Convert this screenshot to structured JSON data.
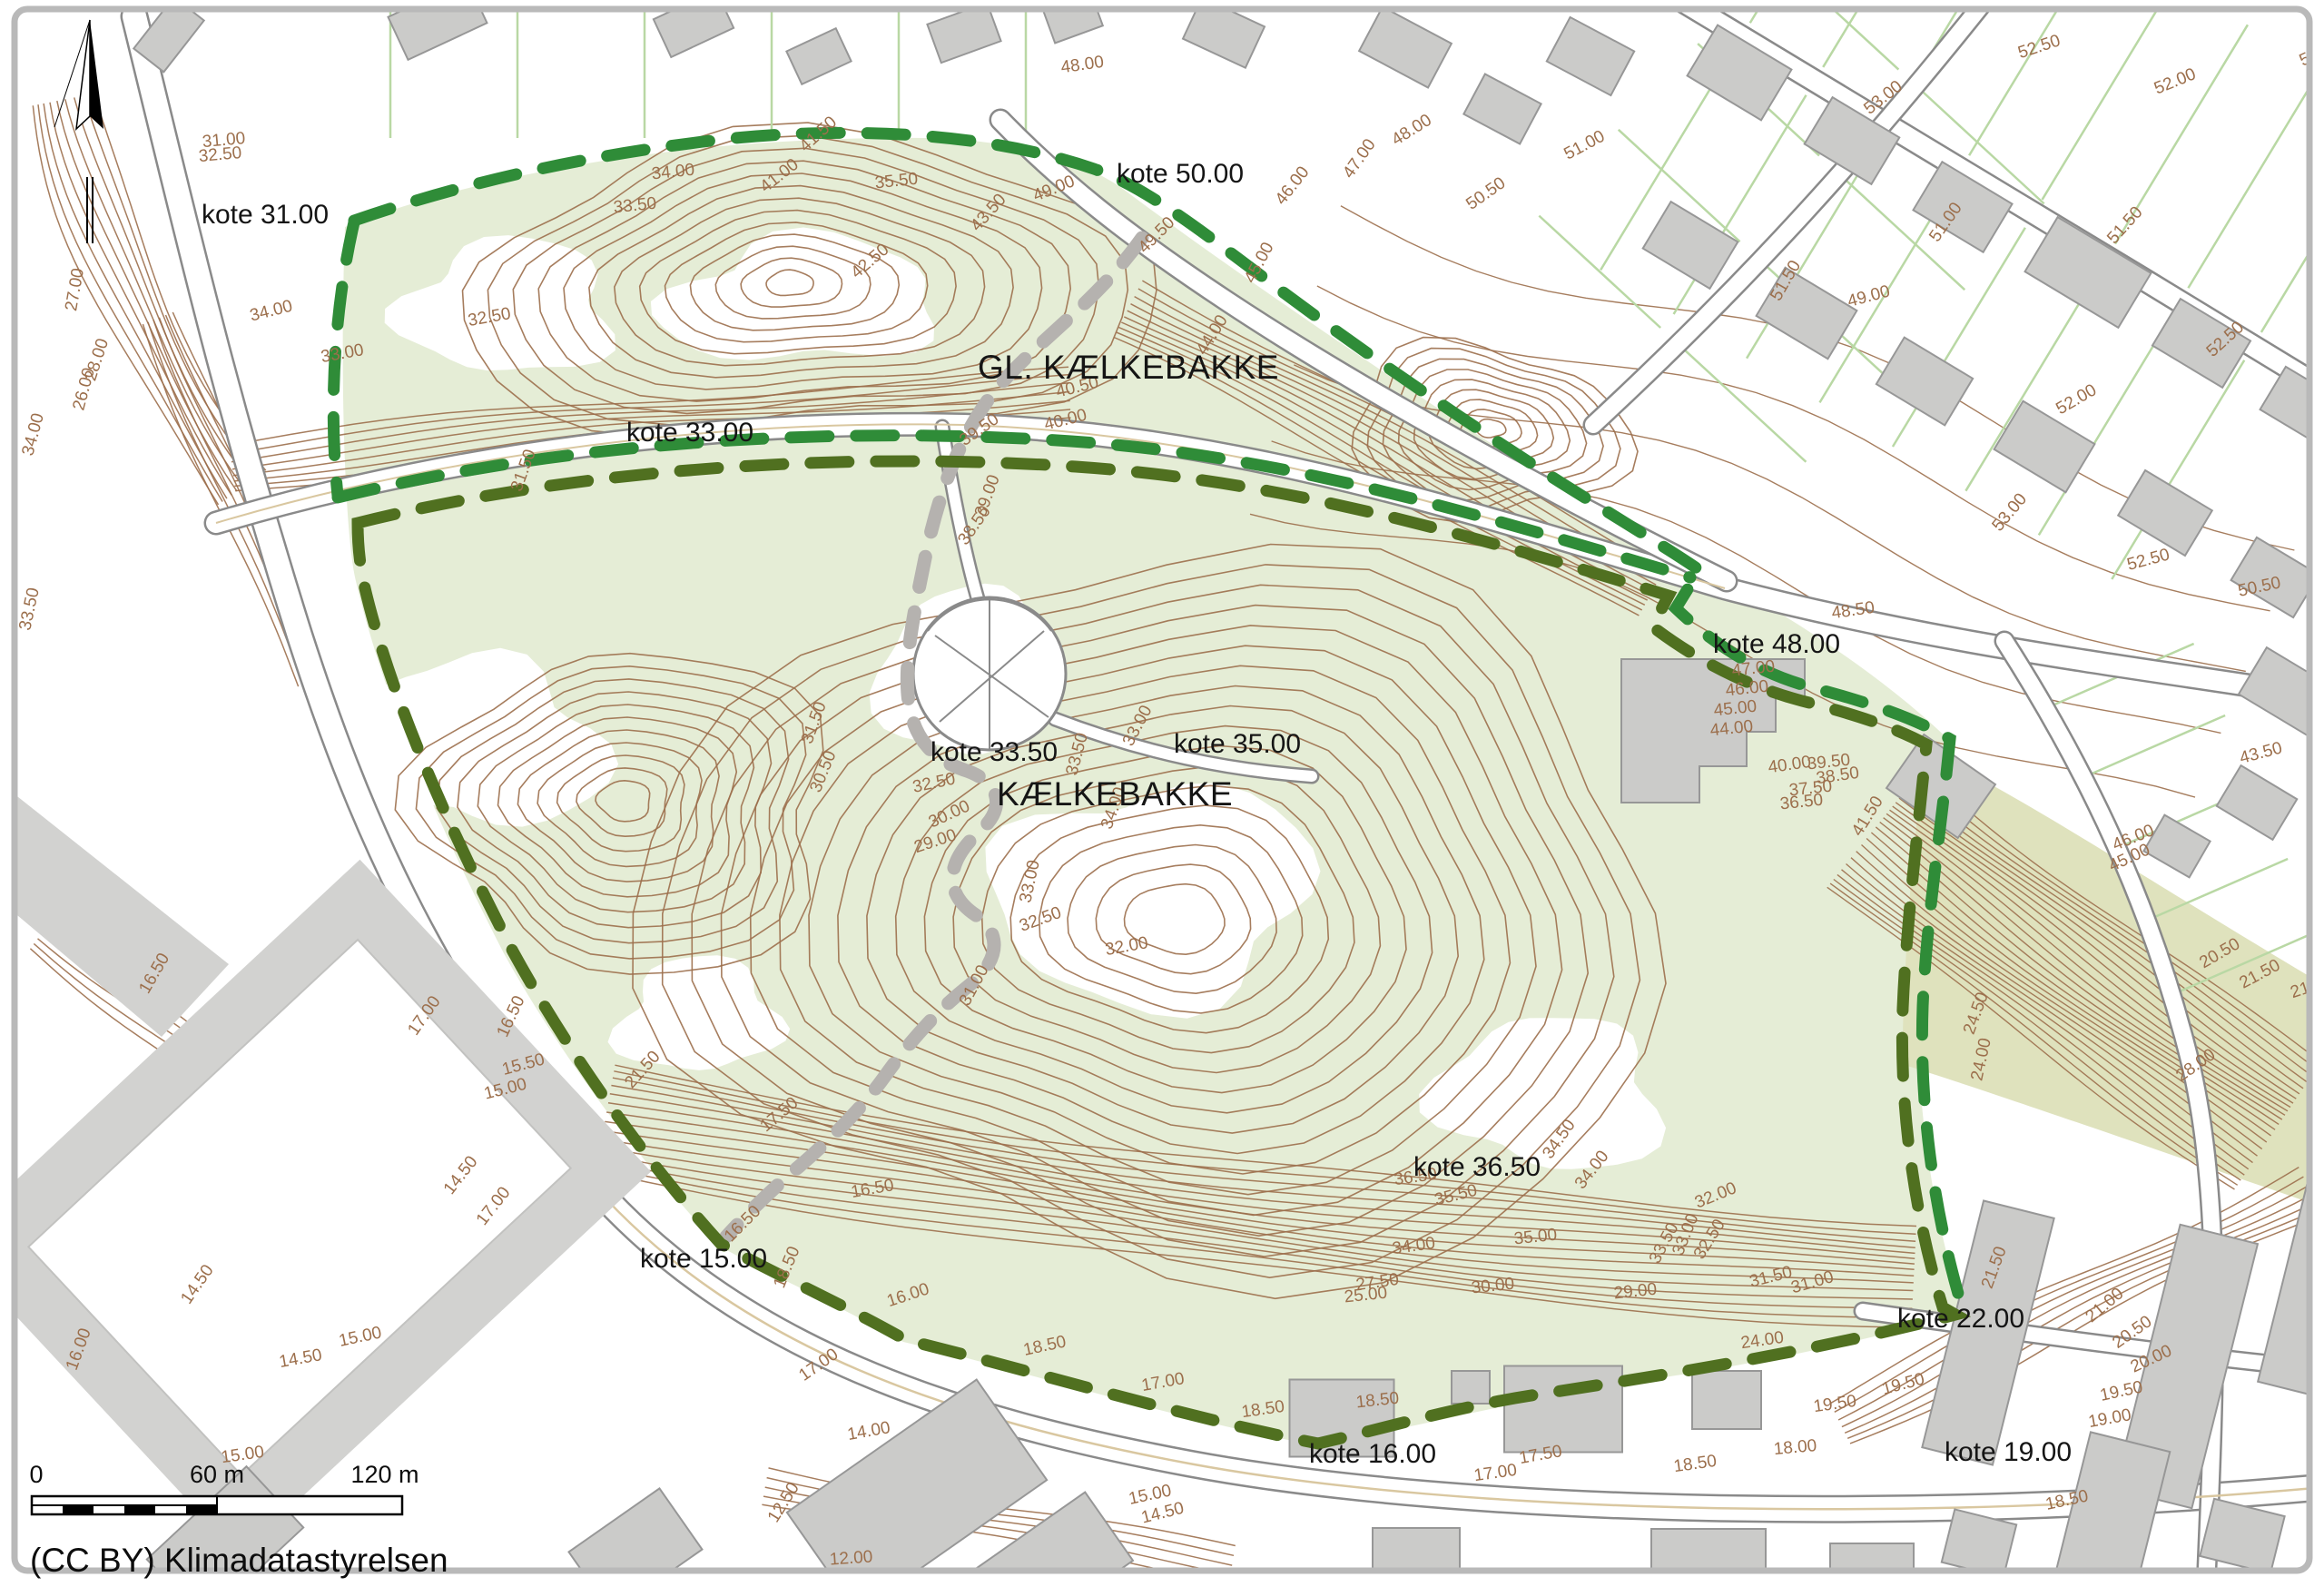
{
  "map": {
    "attribution": "(CC BY) Klimadatastyrelsen",
    "scale_bar": {
      "start": "0",
      "mid": "60 m",
      "end": "120 m"
    },
    "place_labels": [
      {
        "id": "gl-kaelkebakke",
        "text": "GL. KÆLKEBAKKE"
      },
      {
        "id": "kaelkebakke",
        "text": "KÆLKEBAKKE"
      }
    ],
    "kote_labels": [
      {
        "text": "kote 31.00"
      },
      {
        "text": "kote 50.00"
      },
      {
        "text": "kote 33.00"
      },
      {
        "text": "kote 48.00"
      },
      {
        "text": "kote 33.50"
      },
      {
        "text": "kote 35.00"
      },
      {
        "text": "kote 36.50"
      },
      {
        "text": "kote 15.00"
      },
      {
        "text": "kote 22.00"
      },
      {
        "text": "kote 16.00"
      },
      {
        "text": "kote 19.00"
      }
    ],
    "icons": [
      "north-arrow"
    ],
    "colors": {
      "contour": "#9c6f4c",
      "park_fill": "#e5edd6",
      "slope_fill": "#dfe2bd",
      "boundary_bright": "#2f8c38",
      "boundary_dark": "#507020",
      "trail": "#b5b2af",
      "road_casing": "#8a8a8a",
      "road_fill": "#ffffff",
      "building_fill": "#cbcbc9",
      "building_stroke": "#979797",
      "lot_line": "#b9d8a4",
      "tan_line": "#d9c7a0",
      "field_gray": "#d2d2d0",
      "label": "#151515",
      "frame": "#b9b9b9"
    },
    "contour_labels": [
      [
        "48.00",
        1193,
        77,
        -8
      ],
      [
        "52.50",
        2248,
        57,
        -18
      ],
      [
        "52.00",
        2398,
        95,
        -22
      ],
      [
        "53.00",
        2078,
        112,
        -38
      ],
      [
        "51.00",
        1748,
        165,
        -28
      ],
      [
        "50.50",
        1640,
        218,
        -35
      ],
      [
        "49.00",
        1163,
        213,
        -22
      ],
      [
        "49.50",
        1278,
        263,
        -45
      ],
      [
        "51.50",
        2345,
        252,
        -48
      ],
      [
        "52.00",
        2558,
        63,
        -25
      ],
      [
        "51.50",
        1972,
        312,
        -60
      ],
      [
        "52.50",
        2455,
        378,
        -42
      ],
      [
        "52.00",
        2290,
        445,
        -30
      ],
      [
        "53.00",
        2218,
        568,
        -50
      ],
      [
        "52.50",
        2368,
        622,
        -15
      ],
      [
        "50.50",
        2490,
        652,
        -12
      ],
      [
        "49.00",
        2060,
        332,
        -15
      ],
      [
        "51.00",
        2148,
        248,
        -55
      ],
      [
        "41.50",
        905,
        152,
        -42
      ],
      [
        "41.00",
        862,
        198,
        -38
      ],
      [
        "43.50",
        1093,
        238,
        -48
      ],
      [
        "42.50",
        962,
        292,
        -40
      ],
      [
        "45.00",
        1392,
        292,
        -62
      ],
      [
        "44.00",
        1340,
        372,
        -58
      ],
      [
        "46.00",
        1428,
        208,
        -52
      ],
      [
        "47.00",
        1502,
        178,
        -55
      ],
      [
        "48.00",
        1558,
        148,
        -32
      ],
      [
        "40.50",
        1188,
        432,
        -14
      ],
      [
        "40.00",
        1175,
        468,
        -14
      ],
      [
        "39.50",
        1082,
        478,
        -35
      ],
      [
        "39.00",
        1093,
        548,
        -70
      ],
      [
        "38.50",
        1078,
        582,
        -55
      ],
      [
        "35.50",
        988,
        205,
        -6
      ],
      [
        "34.00",
        742,
        195,
        -6
      ],
      [
        "33.50",
        700,
        232,
        -6
      ],
      [
        "34.00",
        300,
        348,
        -14
      ],
      [
        "33.00",
        378,
        395,
        -10
      ],
      [
        "32.50",
        540,
        355,
        -10
      ],
      [
        "31.50",
        582,
        520,
        -70
      ],
      [
        "31.00",
        247,
        160,
        -5
      ],
      [
        "32.50",
        243,
        176,
        -5
      ],
      [
        "34.00",
        42,
        480,
        -75
      ],
      [
        "33.50",
        38,
        672,
        -78
      ],
      [
        "28.00",
        112,
        398,
        -72
      ],
      [
        "27.00",
        88,
        320,
        -80
      ],
      [
        "26.00",
        98,
        430,
        -75
      ],
      [
        "32.50",
        1030,
        868,
        -12
      ],
      [
        "33.00",
        1258,
        802,
        -62
      ],
      [
        "33.50",
        1192,
        832,
        -75
      ],
      [
        "34.00",
        1232,
        892,
        -70
      ],
      [
        "30.00",
        1048,
        902,
        -25
      ],
      [
        "29.00",
        1032,
        932,
        -18
      ],
      [
        "33.00",
        1140,
        972,
        -78
      ],
      [
        "32.50",
        1148,
        1018,
        -20
      ],
      [
        "32.00",
        1242,
        1048,
        -10
      ],
      [
        "31.00",
        1078,
        1088,
        -62
      ],
      [
        "31.50",
        902,
        798,
        -70
      ],
      [
        "30.50",
        912,
        852,
        -68
      ],
      [
        "21.50",
        712,
        1182,
        -48
      ],
      [
        "17.50",
        862,
        1232,
        -40
      ],
      [
        "18.50",
        872,
        1398,
        -68
      ],
      [
        "16.00",
        1002,
        1432,
        -18
      ],
      [
        "18.50",
        1152,
        1488,
        -12
      ],
      [
        "17.00",
        1282,
        1528,
        -10
      ],
      [
        "36.50",
        1560,
        1302,
        -8
      ],
      [
        "35.50",
        1605,
        1322,
        -14
      ],
      [
        "35.00",
        1692,
        1368,
        -6
      ],
      [
        "34.50",
        1722,
        1258,
        -55
      ],
      [
        "34.00",
        1758,
        1292,
        -52
      ],
      [
        "33.50",
        1838,
        1372,
        -62
      ],
      [
        "33.00",
        1862,
        1362,
        -68
      ],
      [
        "32.50",
        1888,
        1368,
        -58
      ],
      [
        "32.00",
        1892,
        1322,
        -22
      ],
      [
        "34.00",
        1558,
        1378,
        -8
      ],
      [
        "30.00",
        1645,
        1422,
        -6
      ],
      [
        "29.00",
        1802,
        1428,
        -6
      ],
      [
        "27.50",
        1518,
        1418,
        -8
      ],
      [
        "25.00",
        1505,
        1432,
        -6
      ],
      [
        "31.50",
        1952,
        1412,
        -14
      ],
      [
        "31.00",
        1998,
        1418,
        -16
      ],
      [
        "24.00",
        1942,
        1482,
        -8
      ],
      [
        "47.00",
        1932,
        742,
        -6
      ],
      [
        "46.00",
        1925,
        764,
        -6
      ],
      [
        "45.00",
        1912,
        786,
        -6
      ],
      [
        "44.00",
        1908,
        808,
        -6
      ],
      [
        "48.50",
        2042,
        678,
        -8
      ],
      [
        "40.00",
        1972,
        848,
        -8
      ],
      [
        "39.50",
        2015,
        845,
        -6
      ],
      [
        "38.50",
        2025,
        860,
        -8
      ],
      [
        "37.50",
        1995,
        874,
        -6
      ],
      [
        "36.50",
        1985,
        889,
        -6
      ],
      [
        "41.50",
        2062,
        902,
        -58
      ],
      [
        "46.00",
        2352,
        928,
        -22
      ],
      [
        "45.00",
        2348,
        950,
        -25
      ],
      [
        "43.50",
        2492,
        835,
        -15
      ],
      [
        "24.50",
        2182,
        1118,
        -70
      ],
      [
        "24.00",
        2188,
        1168,
        -78
      ],
      [
        "28.00",
        2422,
        1178,
        -35
      ],
      [
        "21.50",
        2492,
        1078,
        -28
      ],
      [
        "20.50",
        2448,
        1055,
        -30
      ],
      [
        "21.00",
        2548,
        1092,
        -18
      ],
      [
        "21.50",
        2202,
        1398,
        -70
      ],
      [
        "21.00",
        2322,
        1442,
        -40
      ],
      [
        "20.50",
        2352,
        1472,
        -35
      ],
      [
        "20.00",
        2372,
        1502,
        -25
      ],
      [
        "19.50",
        2338,
        1538,
        -12
      ],
      [
        "19.00",
        2325,
        1568,
        -10
      ],
      [
        "18.50",
        2278,
        1658,
        -12
      ],
      [
        "19.50",
        2098,
        1530,
        -15
      ],
      [
        "18.00",
        1978,
        1600,
        -5
      ],
      [
        "18.50",
        1868,
        1618,
        -8
      ],
      [
        "17.50",
        1698,
        1608,
        -10
      ],
      [
        "17.00",
        1648,
        1628,
        -8
      ],
      [
        "18.50",
        1392,
        1558,
        -8
      ],
      [
        "16.50",
        568,
        1122,
        -65
      ],
      [
        "15.50",
        578,
        1178,
        -15
      ],
      [
        "15.00",
        558,
        1205,
        -14
      ],
      [
        "14.50",
        512,
        1298,
        -52
      ],
      [
        "14.50",
        222,
        1418,
        -55
      ],
      [
        "15.00",
        398,
        1478,
        -12
      ],
      [
        "14.50",
        332,
        1502,
        -10
      ],
      [
        "16.00",
        92,
        1488,
        -70
      ],
      [
        "17.00",
        548,
        1332,
        -52
      ],
      [
        "16.50",
        822,
        1352,
        -45
      ],
      [
        "15.00",
        1268,
        1652,
        -12
      ],
      [
        "14.50",
        1282,
        1672,
        -14
      ],
      [
        "14.00",
        958,
        1582,
        -10
      ],
      [
        "12.00",
        938,
        1722,
        -4
      ],
      [
        "12.50",
        868,
        1658,
        -58
      ],
      [
        "15.00",
        268,
        1608,
        -8
      ],
      [
        "17.00",
        905,
        1508,
        -35
      ],
      [
        "16.50",
        175,
        1075,
        -60
      ],
      [
        "17.00",
        472,
        1122,
        -55
      ],
      [
        "16.50",
        962,
        1315,
        -10
      ],
      [
        "18.50",
        1518,
        1548,
        -6
      ],
      [
        "19.50",
        2022,
        1552,
        -8
      ]
    ]
  }
}
